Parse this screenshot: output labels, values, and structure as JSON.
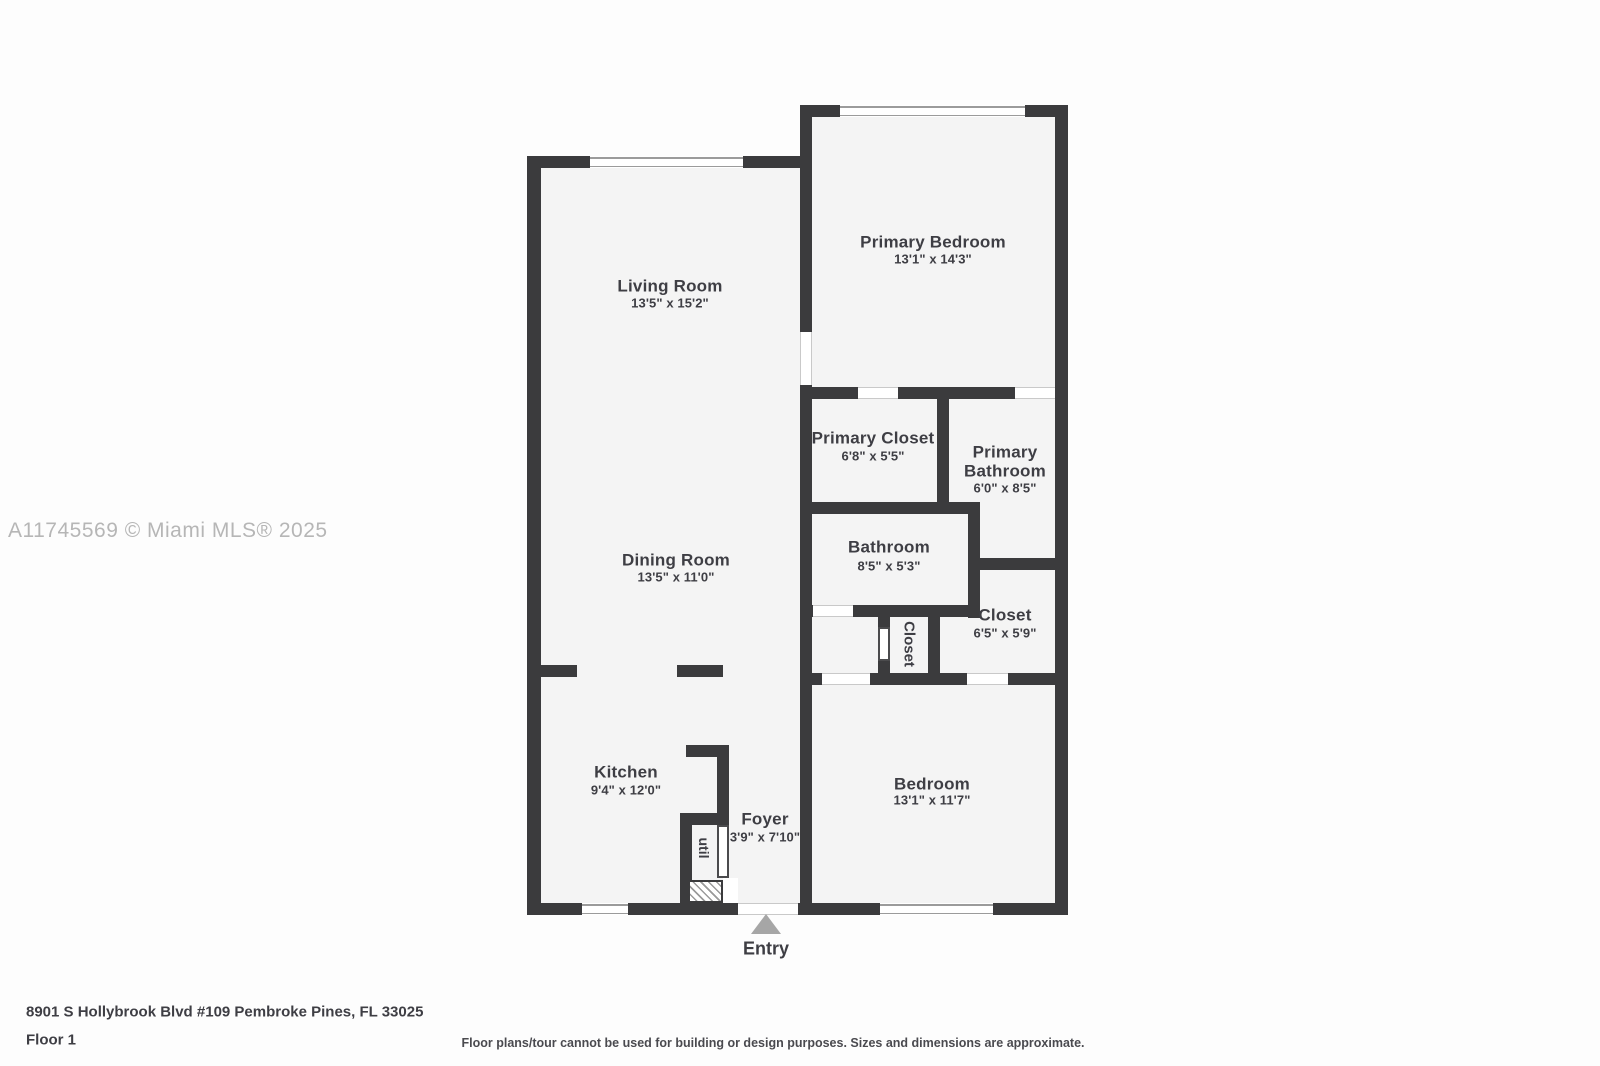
{
  "watermark": "A11745569 © Miami MLS® 2025",
  "entry": {
    "label": "Entry"
  },
  "rooms": {
    "living": {
      "name": "Living Room",
      "dims": "13'5\" x 15'2\""
    },
    "dining": {
      "name": "Dining Room",
      "dims": "13'5\" x 11'0\""
    },
    "kitchen": {
      "name": "Kitchen",
      "dims": "9'4\" x 12'0\""
    },
    "foyer": {
      "name": "Foyer",
      "dims": "3'9\" x 7'10\""
    },
    "primary_bedroom": {
      "name": "Primary Bedroom",
      "dims": "13'1\" x 14'3\""
    },
    "primary_closet": {
      "name": "Primary Closet",
      "dims": "6'8\" x 5'5\""
    },
    "primary_bathroom": {
      "name1": "Primary",
      "name2": "Bathroom",
      "dims": "6'0\" x 8'5\""
    },
    "bathroom": {
      "name": "Bathroom",
      "dims": "8'5\" x 5'3\""
    },
    "bedroom": {
      "name": "Bedroom",
      "dims": "13'1\" x 11'7\""
    },
    "closet": {
      "name": "Closet",
      "dims": "6'5\" x 5'9\""
    },
    "hall_closet": {
      "name": "Closet"
    },
    "util": {
      "name": "util"
    }
  },
  "footer": {
    "address": "8901 S Hollybrook Blvd #109 Pembroke Pines, FL 33025",
    "floor": "Floor 1",
    "disclaimer": "Floor plans/tour cannot be used for building or design purposes. Sizes and dimensions are approximate."
  },
  "colors": {
    "wall": "#3b3b3d",
    "room_fill": "#f4f4f4",
    "text": "#3e3e44",
    "watermark": "#b6b6b6",
    "entry_arrow": "#a6a6a6"
  }
}
